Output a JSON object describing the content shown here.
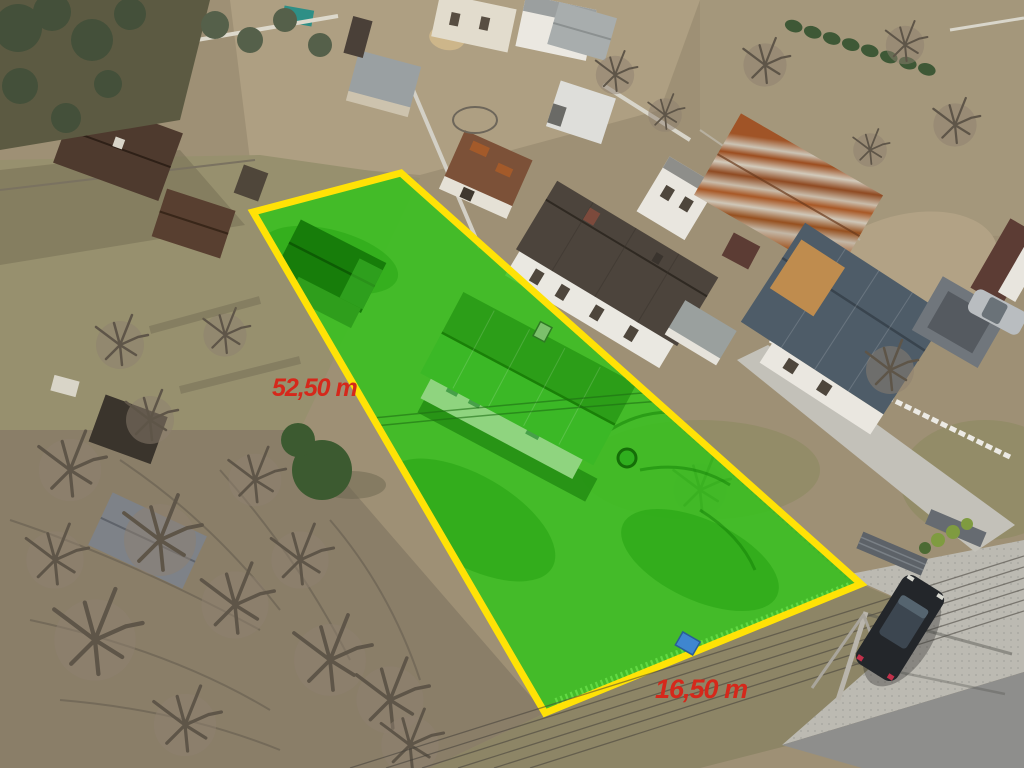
{
  "plot": {
    "highlight_color": "#33c41a",
    "border_color": "#ffe206",
    "label_color": "#d5281b",
    "length_label": "52,50 m",
    "width_label": "16,50 m"
  }
}
